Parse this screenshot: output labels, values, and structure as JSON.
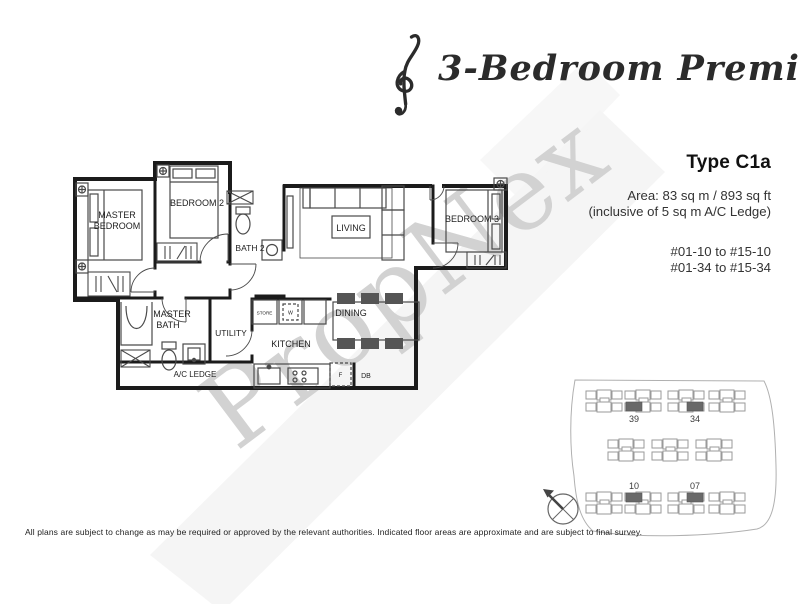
{
  "header": {
    "title": "3-Bedroom Premium"
  },
  "unit_info": {
    "type_label": "Type C1a",
    "area_line1": "Area: 83 sq m / 893 sq ft",
    "area_line2": "(inclusive of 5 sq m A/C Ledge)",
    "stack_line1": "#01-10 to #15-10",
    "stack_line2": "#01-34 to #15-34"
  },
  "floorplan": {
    "rooms": {
      "master_bedroom_l1": "MASTER",
      "master_bedroom_l2": "BEDROOM",
      "bedroom2": "BEDROOM 2",
      "bath2": "BATH 2",
      "living": "LIVING",
      "bedroom3": "BEDROOM 3",
      "master_bath_l1": "MASTER",
      "master_bath_l2": "BATH",
      "utility": "UTILITY",
      "kitchen": "KITCHEN",
      "dining": "DINING",
      "ac_ledge": "A/C LEDGE",
      "store": "STORE",
      "washer": "W",
      "fridge": "F",
      "db": "DB"
    }
  },
  "watermark": {
    "text": "PropNex"
  },
  "site_plan": {
    "highlighted_units": [
      "39",
      "34",
      "10",
      "07"
    ]
  },
  "disclaimer": "All plans are subject to change as may be required or approved by the relevant authorities. Indicated floor areas are approximate and are subject to final survey.",
  "colors": {
    "wall": "#1b1b1b",
    "furniture": "#4a4a4a",
    "watermark": "#d2d2d2",
    "ghost_band": "#f1f1f1",
    "site_outline": "#9a9a9a",
    "site_highlight": "#696969",
    "text": "#222222"
  }
}
